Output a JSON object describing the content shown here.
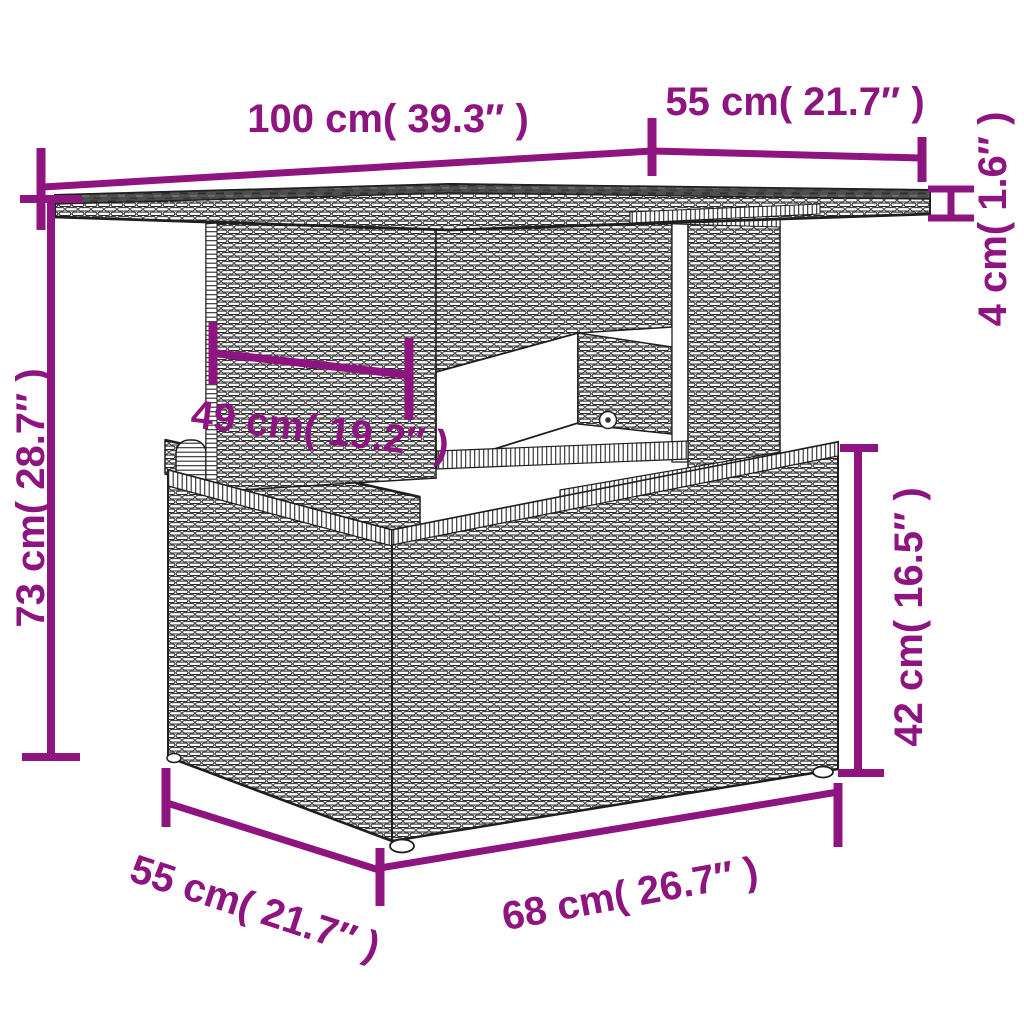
{
  "diagram": {
    "subject": "poly-rattan lift-top garden table line drawing with dimension callouts",
    "colors": {
      "dimension_accent": "#8E1480",
      "line_art": "#1f1f1f",
      "glass_top": "#4f4f4f",
      "background": "#FFFFFF"
    },
    "dimensions": {
      "top_length": "100 cm( 39.3″ )",
      "top_depth": "55 cm( 21.7″ )",
      "top_thickness": "4 cm( 1.6″ )",
      "total_height": "73 cm( 28.7″ )",
      "pedestal_width": "49 cm( 19.2″ )",
      "base_height": "42 cm( 16.5″ )",
      "base_depth": "55 cm( 21.7″ )",
      "base_length": "68 cm( 26.7″ )"
    }
  }
}
